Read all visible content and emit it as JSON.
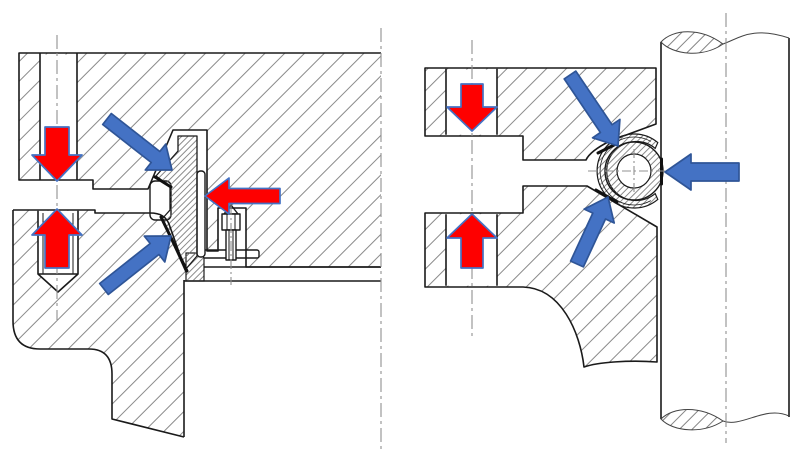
{
  "figure": {
    "kind": "technical-section-diagram",
    "panel_count": 2,
    "panels": [
      {
        "id": "left-view",
        "subject": "bolted-flange-joint-with-wedge-gasket"
      },
      {
        "id": "right-view",
        "subject": "bolted-flange-joint-with-hollow-o-ring-seal-on-shaft"
      }
    ]
  },
  "colors": {
    "red": "#fe0000",
    "red_outline": "#4472c4",
    "blue": "#4472c4",
    "blue_outline": "#2f5597",
    "line": "#1a1a1a",
    "hatch": "#8a8a8a",
    "centerline": "#909090",
    "background": "#ffffff"
  },
  "arrows": [
    {
      "name": "clamp-force-top-left-arrow",
      "color": "red",
      "tail": [
        57,
        127
      ],
      "tip": [
        57,
        181
      ],
      "shaft_width": 24,
      "head_width": 50,
      "head_length": 26
    },
    {
      "name": "clamp-force-bottom-left-arrow",
      "color": "red",
      "tail": [
        57,
        268
      ],
      "tip": [
        57,
        209
      ],
      "shaft_width": 24,
      "head_width": 50,
      "head_length": 26
    },
    {
      "name": "pressure-force-left-arrow",
      "color": "red",
      "tail": [
        280,
        196
      ],
      "tip": [
        205,
        196
      ],
      "shaft_width": 15,
      "head_width": 36,
      "head_length": 24
    },
    {
      "name": "seal-contact-upper-left-arrow",
      "color": "blue",
      "tail": [
        107,
        119
      ],
      "tip": [
        172,
        170
      ],
      "shaft_width": 14,
      "head_width": 33,
      "head_length": 21
    },
    {
      "name": "seal-contact-lower-left-arrow",
      "color": "blue",
      "tail": [
        104,
        289
      ],
      "tip": [
        171,
        236
      ],
      "shaft_width": 14,
      "head_width": 33,
      "head_length": 21
    },
    {
      "name": "clamp-force-top-right-arrow",
      "color": "red",
      "tail": [
        472,
        84
      ],
      "tip": [
        472,
        131
      ],
      "shaft_width": 22,
      "head_width": 50,
      "head_length": 24
    },
    {
      "name": "clamp-force-bottom-right-arrow",
      "color": "red",
      "tail": [
        472,
        268
      ],
      "tip": [
        472,
        214
      ],
      "shaft_width": 22,
      "head_width": 50,
      "head_length": 24
    },
    {
      "name": "seal-contact-upper-right-arrow",
      "color": "blue",
      "tail": [
        570,
        75
      ],
      "tip": [
        618,
        146
      ],
      "shaft_width": 14,
      "head_width": 33,
      "head_length": 21
    },
    {
      "name": "seal-contact-lower-right-arrow",
      "color": "blue",
      "tail": [
        577,
        264
      ],
      "tip": [
        608,
        197
      ],
      "shaft_width": 14,
      "head_width": 33,
      "head_length": 21
    },
    {
      "name": "pressure-force-right-arrow",
      "color": "blue",
      "tail": [
        739,
        172
      ],
      "tip": [
        665,
        172
      ],
      "shaft_width": 18,
      "head_width": 36,
      "head_length": 26
    }
  ]
}
